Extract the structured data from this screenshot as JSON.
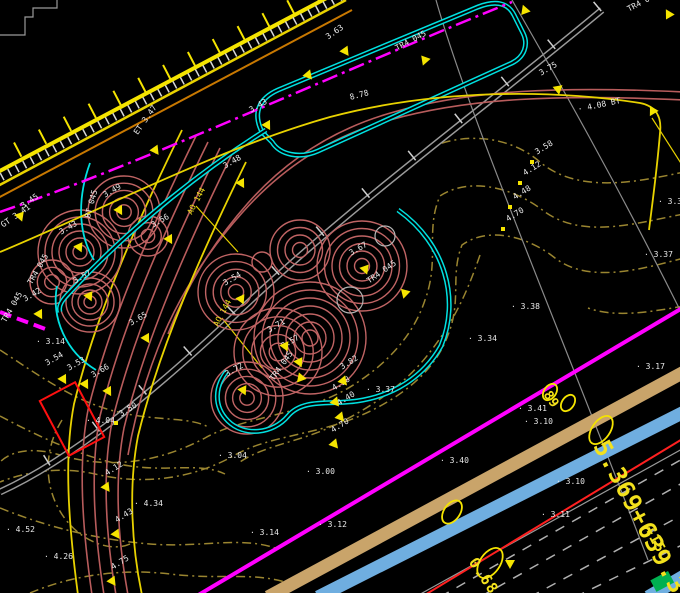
{
  "palette": {
    "background": "#000000",
    "yellow": "#f5e400",
    "orange": "#c87800",
    "magenta": "#ff00ff",
    "cyan": "#00e0e0",
    "tree_brown": "#c06464",
    "contour_olive": "#9a8530",
    "gray": "#9a9a9a",
    "white_text": "#e9e9e9",
    "red": "#ff2020",
    "tan_band": "#c9a46a",
    "blue_band": "#6faee0",
    "green": "#00b050"
  },
  "labels": [
    {
      "t": "3.45",
      "x": 22,
      "y": 203,
      "r": -35,
      "c": "w"
    },
    {
      "t": "GT 3.41",
      "x": 2,
      "y": 222,
      "r": -35,
      "c": "w"
    },
    {
      "t": "TR4 045",
      "x": 4,
      "y": 318,
      "r": -60,
      "c": "w"
    },
    {
      "t": "3.43",
      "x": 60,
      "y": 229,
      "r": -30,
      "c": "w"
    },
    {
      "t": "3.49",
      "x": 104,
      "y": 192,
      "r": -30,
      "c": "w"
    },
    {
      "t": "3.42",
      "x": 24,
      "y": 296,
      "r": -30,
      "c": "w"
    },
    {
      "t": "TR4 045",
      "x": 30,
      "y": 280,
      "r": -60,
      "c": "w"
    },
    {
      "t": "3.57",
      "x": 74,
      "y": 278,
      "r": -30,
      "c": "w"
    },
    {
      "t": "BT 045",
      "x": 88,
      "y": 214,
      "r": -75,
      "c": "w"
    },
    {
      "t": "AO 144",
      "x": 190,
      "y": 210,
      "r": -62,
      "c": "y"
    },
    {
      "t": "AO 144",
      "x": 216,
      "y": 322,
      "r": -62,
      "c": "y"
    },
    {
      "t": "3.54",
      "x": 224,
      "y": 280,
      "r": -30,
      "c": "w"
    },
    {
      "t": "3.67",
      "x": 350,
      "y": 250,
      "r": -30,
      "c": "w"
    },
    {
      "t": "TR4 045",
      "x": 368,
      "y": 278,
      "r": -35,
      "c": "w"
    },
    {
      "t": "3.71",
      "x": 268,
      "y": 327,
      "r": -30,
      "c": "w"
    },
    {
      "t": "3.57",
      "x": 282,
      "y": 343,
      "r": -30,
      "c": "w"
    },
    {
      "t": "3.72",
      "x": 226,
      "y": 371,
      "r": -30,
      "c": "w"
    },
    {
      "t": "TR4 045",
      "x": 272,
      "y": 376,
      "r": -55,
      "c": "w"
    },
    {
      "t": "3.65",
      "x": 130,
      "y": 320,
      "r": -30,
      "c": "w"
    },
    {
      "t": "3.54",
      "x": 46,
      "y": 360,
      "r": -30,
      "c": "w"
    },
    {
      "t": "3.53",
      "x": 68,
      "y": 365,
      "r": -30,
      "c": "w"
    },
    {
      "t": "3.66",
      "x": 92,
      "y": 372,
      "r": -30,
      "c": "w"
    },
    {
      "t": "3.56",
      "x": 152,
      "y": 222,
      "r": -30,
      "c": "w"
    },
    {
      "t": "ET 3.47",
      "x": 136,
      "y": 130,
      "r": -55,
      "c": "w"
    },
    {
      "t": "3.63",
      "x": 327,
      "y": 34,
      "r": -35,
      "c": "w"
    },
    {
      "t": "TR4 045",
      "x": 396,
      "y": 45,
      "r": -28,
      "c": "w"
    },
    {
      "t": "8.78",
      "x": 350,
      "y": 94,
      "r": -15,
      "c": "w"
    },
    {
      "t": "3.75",
      "x": 540,
      "y": 70,
      "r": -30,
      "c": "w"
    },
    {
      "t": "3.43",
      "x": 250,
      "y": 107,
      "r": -30,
      "c": "w"
    },
    {
      "t": "3.48",
      "x": 224,
      "y": 163,
      "r": -30,
      "c": "w"
    },
    {
      "t": "TR4 045",
      "x": 628,
      "y": 6,
      "r": -28,
      "c": "w"
    },
    {
      "t": "· 4.08 BT",
      "x": 578,
      "y": 106,
      "r": -12,
      "c": "w"
    },
    {
      "t": "3.58",
      "x": 536,
      "y": 149,
      "r": -32,
      "c": "w"
    },
    {
      "t": "4.12",
      "x": 524,
      "y": 170,
      "r": -32,
      "c": "w"
    },
    {
      "t": "4.48",
      "x": 514,
      "y": 194,
      "r": -32,
      "c": "w"
    },
    {
      "t": "4.70",
      "x": 507,
      "y": 216,
      "r": -32,
      "c": "w"
    },
    {
      "t": "· 3.30",
      "x": 658,
      "y": 198,
      "r": 0,
      "c": "w"
    },
    {
      "t": "· 3.37",
      "x": 644,
      "y": 251,
      "r": 0,
      "c": "w"
    },
    {
      "t": "· 3.38",
      "x": 511,
      "y": 303,
      "r": 0,
      "c": "w"
    },
    {
      "t": "· 3.34",
      "x": 468,
      "y": 335,
      "r": 0,
      "c": "w"
    },
    {
      "t": "· 3.17",
      "x": 636,
      "y": 363,
      "r": 0,
      "c": "w"
    },
    {
      "t": "· 3.14",
      "x": 36,
      "y": 338,
      "r": 0,
      "c": "w"
    },
    {
      "t": "3.82",
      "x": 341,
      "y": 364,
      "r": -32,
      "c": "w"
    },
    {
      "t": "4.38",
      "x": 333,
      "y": 385,
      "r": -32,
      "c": "w"
    },
    {
      "t": "4.40",
      "x": 338,
      "y": 400,
      "r": -32,
      "c": "w"
    },
    {
      "t": "4.70",
      "x": 332,
      "y": 427,
      "r": -32,
      "c": "w"
    },
    {
      "t": "· 3.37",
      "x": 366,
      "y": 386,
      "r": 0,
      "c": "w"
    },
    {
      "t": "3.50",
      "x": 120,
      "y": 411,
      "r": -32,
      "c": "w"
    },
    {
      "t": "· 4.04",
      "x": 86,
      "y": 417,
      "r": 0,
      "c": "w"
    },
    {
      "t": "4.12",
      "x": 106,
      "y": 470,
      "r": -32,
      "c": "w"
    },
    {
      "t": "· 4.34",
      "x": 134,
      "y": 500,
      "r": 0,
      "c": "w"
    },
    {
      "t": "4.43",
      "x": 116,
      "y": 517,
      "r": -32,
      "c": "w"
    },
    {
      "t": "4.75",
      "x": 112,
      "y": 564,
      "r": -32,
      "c": "w"
    },
    {
      "t": "· 4.52",
      "x": 6,
      "y": 526,
      "r": 0,
      "c": "w"
    },
    {
      "t": "· 4.26",
      "x": 44,
      "y": 553,
      "r": 0,
      "c": "w"
    },
    {
      "t": "· 3.04",
      "x": 218,
      "y": 452,
      "r": 0,
      "c": "w"
    },
    {
      "t": "· 3.00",
      "x": 306,
      "y": 468,
      "r": 0,
      "c": "w"
    },
    {
      "t": "· 3.14",
      "x": 250,
      "y": 529,
      "r": 0,
      "c": "w"
    },
    {
      "t": "· 3.12",
      "x": 318,
      "y": 521,
      "r": 0,
      "c": "w"
    },
    {
      "t": "· 3.41",
      "x": 518,
      "y": 405,
      "r": 0,
      "c": "w"
    },
    {
      "t": "· 3.10",
      "x": 524,
      "y": 418,
      "r": 0,
      "c": "w"
    },
    {
      "t": "· 3.40",
      "x": 440,
      "y": 457,
      "r": 0,
      "c": "w"
    },
    {
      "t": "· 3.10",
      "x": 556,
      "y": 478,
      "r": 0,
      "c": "w"
    },
    {
      "t": "· 3.11",
      "x": 541,
      "y": 511,
      "r": 0,
      "c": "w"
    }
  ],
  "big_annotations": [
    {
      "t": "5.369+639.3",
      "x": 600,
      "y": 430,
      "r": 62,
      "s": 24
    },
    {
      "t": "0.68",
      "x": 472,
      "y": 552,
      "r": 56,
      "s": 15
    },
    {
      "t": "+15",
      "x": 648,
      "y": 520,
      "r": 62,
      "s": 14
    },
    {
      "t": "89",
      "x": 546,
      "y": 386,
      "r": 56,
      "s": 13
    }
  ],
  "markers": [
    {
      "k": "tri",
      "x": 15,
      "y": 213,
      "r": -20
    },
    {
      "k": "tri",
      "x": 150,
      "y": 147,
      "r": -35
    },
    {
      "k": "tri",
      "x": 262,
      "y": 122,
      "r": -30
    },
    {
      "k": "tri",
      "x": 236,
      "y": 180,
      "r": -30
    },
    {
      "k": "tri",
      "x": 164,
      "y": 236,
      "r": -30
    },
    {
      "k": "tri",
      "x": 303,
      "y": 72,
      "r": -40
    },
    {
      "k": "tri",
      "x": 340,
      "y": 48,
      "r": -35
    },
    {
      "k": "tri",
      "x": 420,
      "y": 57,
      "r": 20
    },
    {
      "k": "tri",
      "x": 553,
      "y": 86,
      "r": -10
    },
    {
      "k": "tri",
      "x": 520,
      "y": 8,
      "r": 160
    },
    {
      "k": "tri",
      "x": 664,
      "y": 12,
      "r": 150
    },
    {
      "k": "tri",
      "x": 648,
      "y": 108,
      "r": 30
    },
    {
      "k": "tri",
      "x": 74,
      "y": 244,
      "r": -25
    },
    {
      "k": "tri",
      "x": 114,
      "y": 207,
      "r": -30
    },
    {
      "k": "tri",
      "x": 34,
      "y": 311,
      "r": -30
    },
    {
      "k": "tri",
      "x": 84,
      "y": 293,
      "r": -25
    },
    {
      "k": "tri",
      "x": 236,
      "y": 296,
      "r": -25
    },
    {
      "k": "tri",
      "x": 360,
      "y": 266,
      "r": -20
    },
    {
      "k": "tri",
      "x": 400,
      "y": 290,
      "r": 15
    },
    {
      "k": "tri",
      "x": 280,
      "y": 343,
      "r": -25
    },
    {
      "k": "tri",
      "x": 294,
      "y": 359,
      "r": -25
    },
    {
      "k": "tri",
      "x": 238,
      "y": 387,
      "r": -25
    },
    {
      "k": "tri",
      "x": 296,
      "y": 375,
      "r": 40
    },
    {
      "k": "tri",
      "x": 58,
      "y": 376,
      "r": -30
    },
    {
      "k": "tri",
      "x": 80,
      "y": 381,
      "r": -30
    },
    {
      "k": "tri",
      "x": 103,
      "y": 388,
      "r": -30
    },
    {
      "k": "tri",
      "x": 141,
      "y": 335,
      "r": -30
    },
    {
      "k": "tri",
      "x": 338,
      "y": 378,
      "r": -40
    },
    {
      "k": "tri",
      "x": 330,
      "y": 399,
      "r": -40
    },
    {
      "k": "tri",
      "x": 335,
      "y": 414,
      "r": -40
    },
    {
      "k": "tri",
      "x": 329,
      "y": 441,
      "r": -40
    },
    {
      "k": "tri",
      "x": 101,
      "y": 484,
      "r": -35
    },
    {
      "k": "tri",
      "x": 111,
      "y": 531,
      "r": -35
    },
    {
      "k": "tri",
      "x": 107,
      "y": 578,
      "r": -35
    },
    {
      "k": "tri",
      "x": 505,
      "y": 560,
      "r": 0
    },
    {
      "k": "dot",
      "x": 530,
      "y": 160,
      "r": 0
    },
    {
      "k": "dot",
      "x": 518,
      "y": 181,
      "r": 0
    },
    {
      "k": "dot",
      "x": 508,
      "y": 205,
      "r": 0
    },
    {
      "k": "dot",
      "x": 501,
      "y": 227,
      "r": 0
    },
    {
      "k": "dot",
      "x": 114,
      "y": 421,
      "r": 0
    }
  ],
  "trees": [
    {
      "x": 80,
      "y": 252,
      "rr": 42,
      "rings": 6
    },
    {
      "x": 124,
      "y": 212,
      "rr": 36,
      "rings": 5
    },
    {
      "x": 90,
      "y": 302,
      "rr": 30,
      "rings": 5
    },
    {
      "x": 52,
      "y": 282,
      "rr": 22,
      "rings": 3
    },
    {
      "x": 148,
      "y": 236,
      "rr": 20,
      "rings": 3
    },
    {
      "x": 236,
      "y": 292,
      "rr": 38,
      "rings": 5
    },
    {
      "x": 310,
      "y": 338,
      "rr": 56,
      "rings": 7
    },
    {
      "x": 278,
      "y": 352,
      "rr": 44,
      "rings": 5
    },
    {
      "x": 247,
      "y": 398,
      "rr": 36,
      "rings": 5
    },
    {
      "x": 362,
      "y": 266,
      "rr": 45,
      "rings": 6
    },
    {
      "x": 300,
      "y": 250,
      "rr": 30,
      "rings": 4
    },
    {
      "x": 262,
      "y": 262,
      "rr": 10,
      "rings": 1
    },
    {
      "x": 350,
      "y": 300,
      "rr": 13,
      "rings": 1,
      "cls": "treegray"
    },
    {
      "x": 385,
      "y": 236,
      "rr": 10,
      "rings": 1,
      "cls": "treegray"
    }
  ]
}
